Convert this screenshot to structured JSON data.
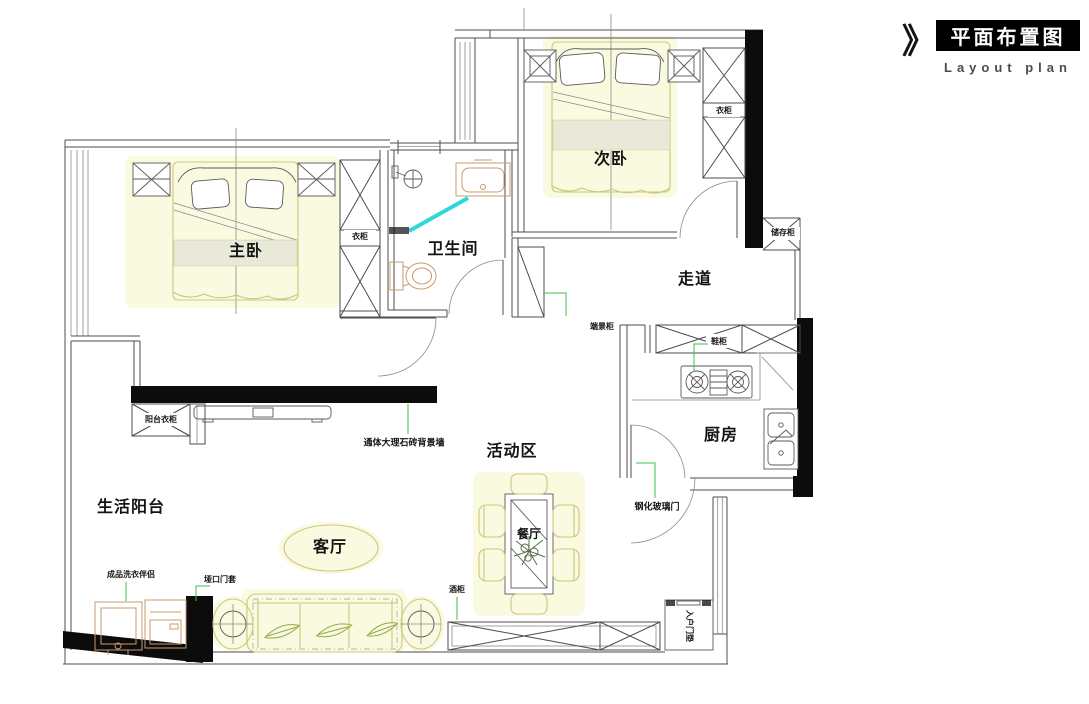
{
  "header": {
    "chevron": "》",
    "title": "平面布置图",
    "subtitle": "Layout plan"
  },
  "rooms": {
    "master_bedroom": "主卧",
    "second_bedroom": "次卧",
    "bathroom": "卫生间",
    "corridor": "走道",
    "kitchen": "厨房",
    "activity_area": "活动区",
    "living_room": "客厅",
    "dining_room": "餐厅",
    "balcony": "生活阳台"
  },
  "annotations": {
    "master_wardrobe": "衣柜",
    "second_wardrobe": "衣柜",
    "storage_cabinet": "储存柜",
    "endview_cabinet": "端景柜",
    "shoe_cabinet": "鞋柜",
    "balcony_wardrobe": "阳台衣柜",
    "marble_wall": "通体大理石砖背景墙",
    "glass_door": "钢化玻璃门",
    "laundry_unit": "成品洗衣伴侣",
    "door_casing": "垭口门套",
    "wine_cabinet": "酒柜",
    "entry_mat": "入户门垫"
  },
  "colors": {
    "wall_line": "#4c4c4c",
    "black_wall": "#0c0c0c",
    "furniture_yellow": "#c9c87f",
    "fixture_orange": "#c89a6b",
    "leader_green": "#3fbf49",
    "glass_cyan": "#2fd8d8",
    "title_bg": "#000000",
    "title_fg": "#ffffff",
    "subtitle_fg": "#4c4c4c"
  }
}
